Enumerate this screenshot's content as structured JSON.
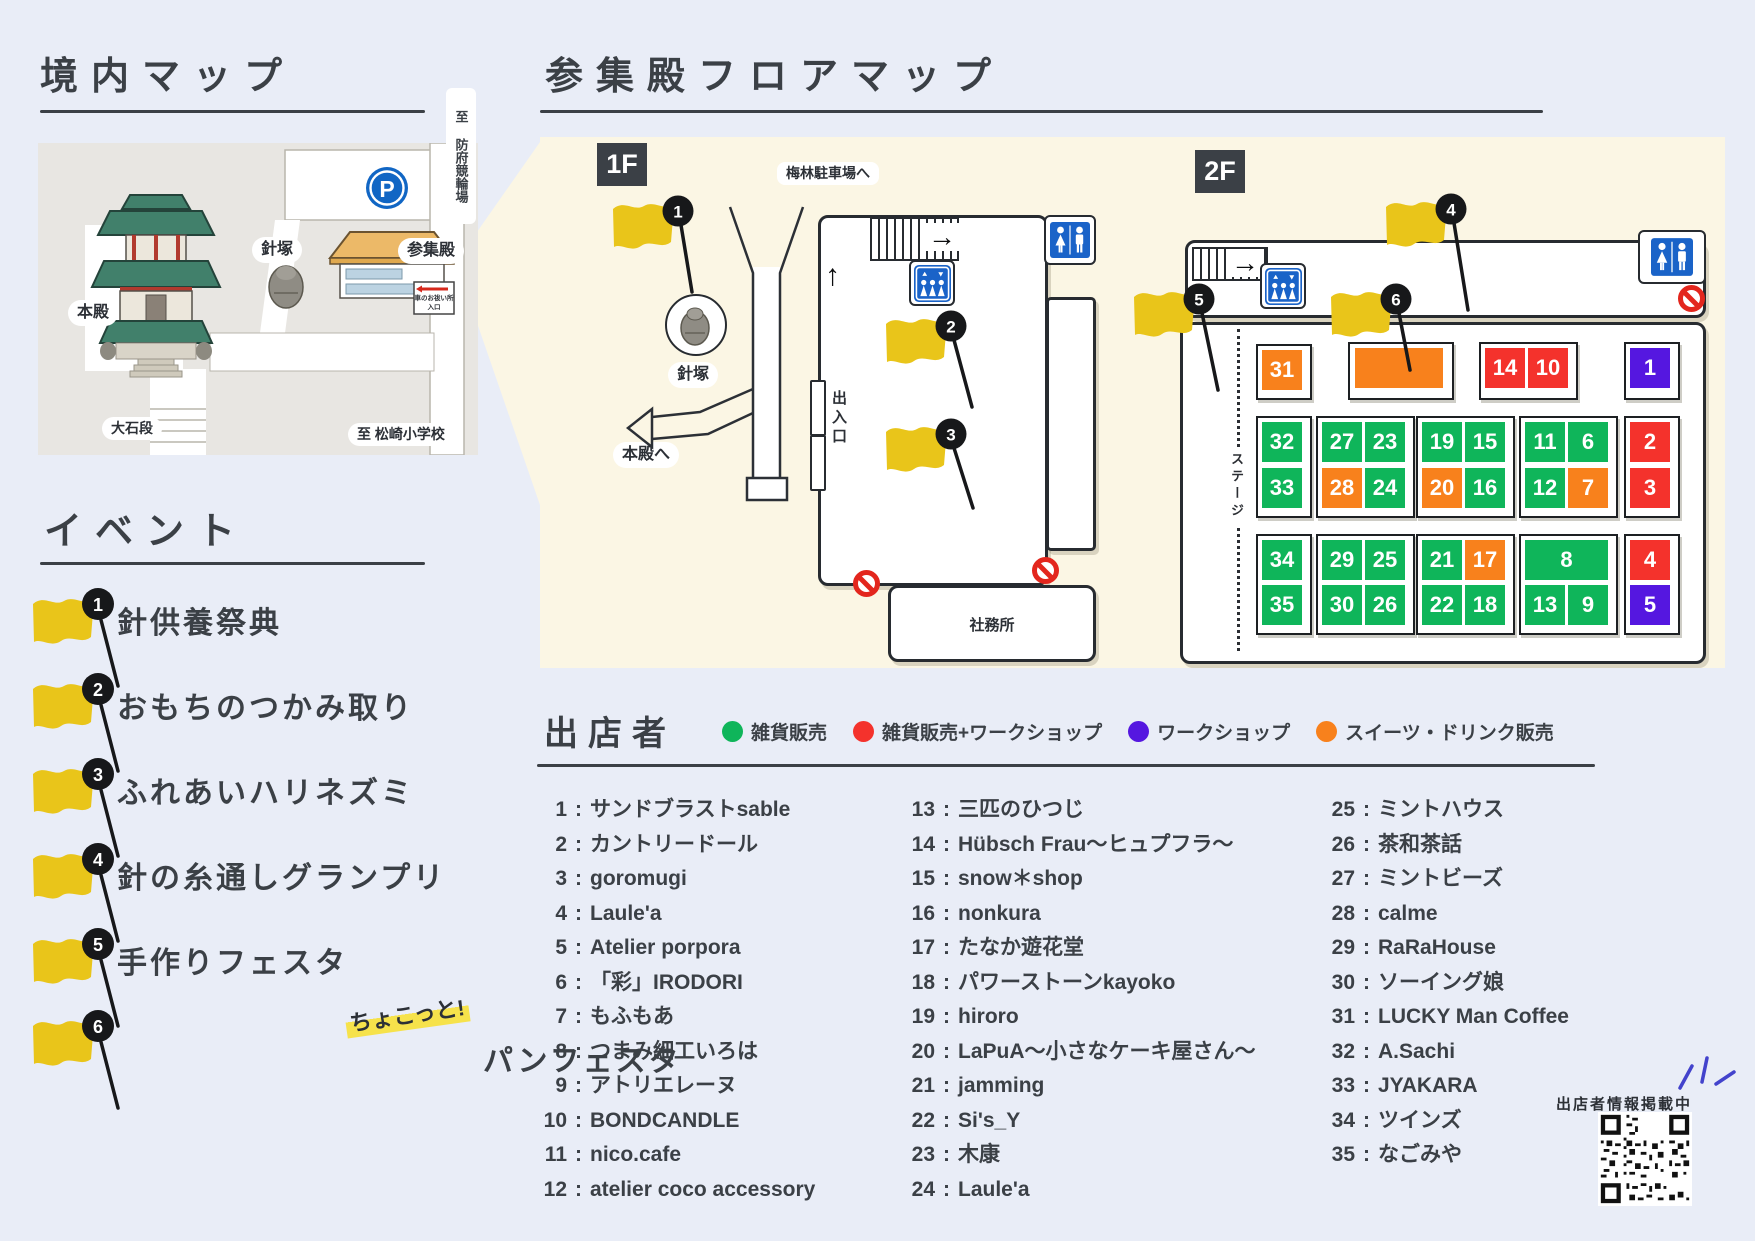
{
  "keidai": {
    "title": "境内マップ",
    "labels": {
      "honden": "本殿",
      "harizuka": "針塚",
      "sanshuden": "参集殿",
      "parking": "P",
      "oishidan": "大石段",
      "to_keirin": "至 防府競輪場",
      "to_school": "至 松崎小学校",
      "sign_line1": "車のお祓い所",
      "sign_line2": "入口"
    }
  },
  "floor_map": {
    "title": "参集殿フロアマップ",
    "f1": {
      "badge": "1F",
      "parking_label": "梅林駐車場へ",
      "harizuka": "針塚",
      "to_honden": "本殿へ",
      "entrance": "出入口",
      "office": "社務所"
    },
    "f2": {
      "badge": "2F",
      "stage": "ステージ"
    },
    "booth_colors": {
      "g": "#0fb55a",
      "r": "#f4322c",
      "p": "#5517e0",
      "o": "#f8811c"
    },
    "booths": [
      {
        "n": "31",
        "t": "o",
        "x": 722,
        "y": 213
      },
      {
        "n": "",
        "t": "o",
        "x": 815,
        "y": 211,
        "w": 88
      },
      {
        "n": "14",
        "t": "r",
        "x": 945,
        "y": 211
      },
      {
        "n": "10",
        "t": "r",
        "x": 988,
        "y": 211
      },
      {
        "n": "1",
        "t": "p",
        "x": 1090,
        "y": 211
      },
      {
        "n": "32",
        "t": "g",
        "x": 722,
        "y": 285
      },
      {
        "n": "33",
        "t": "g",
        "x": 722,
        "y": 331
      },
      {
        "n": "27",
        "t": "g",
        "x": 782,
        "y": 285
      },
      {
        "n": "23",
        "t": "g",
        "x": 825,
        "y": 285
      },
      {
        "n": "28",
        "t": "o",
        "x": 782,
        "y": 331
      },
      {
        "n": "24",
        "t": "g",
        "x": 825,
        "y": 331
      },
      {
        "n": "19",
        "t": "g",
        "x": 882,
        "y": 285
      },
      {
        "n": "15",
        "t": "g",
        "x": 925,
        "y": 285
      },
      {
        "n": "20",
        "t": "o",
        "x": 882,
        "y": 331
      },
      {
        "n": "16",
        "t": "g",
        "x": 925,
        "y": 331
      },
      {
        "n": "11",
        "t": "g",
        "x": 985,
        "y": 285
      },
      {
        "n": "6",
        "t": "g",
        "x": 1028,
        "y": 285
      },
      {
        "n": "12",
        "t": "g",
        "x": 985,
        "y": 331
      },
      {
        "n": "7",
        "t": "o",
        "x": 1028,
        "y": 331
      },
      {
        "n": "2",
        "t": "r",
        "x": 1090,
        "y": 285
      },
      {
        "n": "3",
        "t": "r",
        "x": 1090,
        "y": 331
      },
      {
        "n": "34",
        "t": "g",
        "x": 722,
        "y": 403
      },
      {
        "n": "35",
        "t": "g",
        "x": 722,
        "y": 448
      },
      {
        "n": "29",
        "t": "g",
        "x": 782,
        "y": 403
      },
      {
        "n": "25",
        "t": "g",
        "x": 825,
        "y": 403
      },
      {
        "n": "30",
        "t": "g",
        "x": 782,
        "y": 448
      },
      {
        "n": "26",
        "t": "g",
        "x": 825,
        "y": 448
      },
      {
        "n": "21",
        "t": "g",
        "x": 882,
        "y": 403
      },
      {
        "n": "17",
        "t": "o",
        "x": 925,
        "y": 403
      },
      {
        "n": "22",
        "t": "g",
        "x": 882,
        "y": 448
      },
      {
        "n": "18",
        "t": "g",
        "x": 925,
        "y": 448
      },
      {
        "n": "8",
        "t": "g",
        "x": 985,
        "y": 403,
        "w": 83
      },
      {
        "n": "13",
        "t": "g",
        "x": 985,
        "y": 448
      },
      {
        "n": "9",
        "t": "g",
        "x": 1028,
        "y": 448
      },
      {
        "n": "4",
        "t": "r",
        "x": 1090,
        "y": 403
      },
      {
        "n": "5",
        "t": "p",
        "x": 1090,
        "y": 448
      }
    ],
    "cluster_frames": [
      {
        "x": 716,
        "y": 207,
        "w": 52,
        "h": 52
      },
      {
        "x": 808,
        "y": 205,
        "w": 102,
        "h": 54
      },
      {
        "x": 939,
        "y": 205,
        "w": 95,
        "h": 54
      },
      {
        "x": 1084,
        "y": 205,
        "w": 52,
        "h": 54
      },
      {
        "x": 716,
        "y": 279,
        "w": 52,
        "h": 98
      },
      {
        "x": 776,
        "y": 279,
        "w": 95,
        "h": 98
      },
      {
        "x": 876,
        "y": 279,
        "w": 95,
        "h": 98
      },
      {
        "x": 979,
        "y": 279,
        "w": 95,
        "h": 98
      },
      {
        "x": 1084,
        "y": 279,
        "w": 52,
        "h": 98
      },
      {
        "x": 716,
        "y": 397,
        "w": 52,
        "h": 97
      },
      {
        "x": 776,
        "y": 397,
        "w": 95,
        "h": 97
      },
      {
        "x": 876,
        "y": 397,
        "w": 95,
        "h": 97
      },
      {
        "x": 979,
        "y": 397,
        "w": 95,
        "h": 97
      },
      {
        "x": 1084,
        "y": 397,
        "w": 52,
        "h": 97
      }
    ],
    "flags": [
      {
        "num": "1",
        "x": 72,
        "y": 60,
        "px": 152,
        "py": 155
      },
      {
        "num": "2",
        "x": 345,
        "y": 175,
        "px": 432,
        "py": 270
      },
      {
        "num": "3",
        "x": 345,
        "y": 283,
        "px": 433,
        "py": 371
      },
      {
        "num": "4",
        "x": 845,
        "y": 58,
        "px": 928,
        "py": 173
      },
      {
        "num": "5",
        "x": 593,
        "y": 148,
        "px": 678,
        "py": 253
      },
      {
        "num": "6",
        "x": 790,
        "y": 148,
        "px": 870,
        "py": 233
      }
    ]
  },
  "events": {
    "title": "イベント",
    "items": [
      {
        "num": "1",
        "prefix": "",
        "label": "針供養祭典"
      },
      {
        "num": "2",
        "prefix": "",
        "label": "おもちのつかみ取り"
      },
      {
        "num": "3",
        "prefix": "",
        "label": "ふれあいハリネズミ"
      },
      {
        "num": "4",
        "prefix": "",
        "label": "針の糸通しグランプリ"
      },
      {
        "num": "5",
        "prefix": "",
        "label": "手作りフェスタ"
      },
      {
        "num": "6",
        "prefix": "ちょこっと!",
        "label": "パンフェスタ"
      }
    ]
  },
  "vendors": {
    "title": "出店者",
    "legend": [
      {
        "color": "#0fb55a",
        "label": "雑貨販売"
      },
      {
        "color": "#f4322c",
        "label": "雑貨販売+ワークショップ"
      },
      {
        "color": "#5517e0",
        "label": "ワークショップ"
      },
      {
        "color": "#f8811c",
        "label": "スイーツ・ドリンク販売"
      }
    ],
    "columns": [
      [
        {
          "n": "1",
          "label": "サンドブラストsable"
        },
        {
          "n": "2",
          "label": "カントリードール"
        },
        {
          "n": "3",
          "label": "goromugi"
        },
        {
          "n": "4",
          "label": "Laule'a"
        },
        {
          "n": "5",
          "label": "Atelier porpora"
        },
        {
          "n": "6",
          "label": "「彩」IRODORI"
        },
        {
          "n": "7",
          "label": "もふもあ"
        },
        {
          "n": "8",
          "label": "つまみ細工いろは"
        },
        {
          "n": "9",
          "label": "アトリエレーヌ"
        },
        {
          "n": "10",
          "label": "BONDCANDLE"
        },
        {
          "n": "11",
          "label": "nico.cafe"
        },
        {
          "n": "12",
          "label": "atelier coco accessory"
        }
      ],
      [
        {
          "n": "13",
          "label": "三匹のひつじ"
        },
        {
          "n": "14",
          "label": "Hübsch Frau～ヒュプフラ～"
        },
        {
          "n": "15",
          "label": "snow＊shop"
        },
        {
          "n": "16",
          "label": "nonkura"
        },
        {
          "n": "17",
          "label": "たなか遊花堂"
        },
        {
          "n": "18",
          "label": "パワーストーンkayoko"
        },
        {
          "n": "19",
          "label": "hiroro"
        },
        {
          "n": "20",
          "label": "LaPuA～小さなケーキ屋さん～"
        },
        {
          "n": "21",
          "label": "jamming"
        },
        {
          "n": "22",
          "label": "Si's_Y"
        },
        {
          "n": "23",
          "label": "木康"
        },
        {
          "n": "24",
          "label": "Laule'a"
        }
      ],
      [
        {
          "n": "25",
          "label": "ミントハウス"
        },
        {
          "n": "26",
          "label": "茶和茶話"
        },
        {
          "n": "27",
          "label": "ミントビーズ"
        },
        {
          "n": "28",
          "label": "calme"
        },
        {
          "n": "29",
          "label": "RaRaHouse"
        },
        {
          "n": "30",
          "label": "ソーイング娘"
        },
        {
          "n": "31",
          "label": "LUCKY Man Coffee"
        },
        {
          "n": "32",
          "label": "A.Sachi"
        },
        {
          "n": "33",
          "label": "JYAKARA"
        },
        {
          "n": "34",
          "label": "ツインズ"
        },
        {
          "n": "35",
          "label": "なごみや"
        }
      ]
    ],
    "qr_note": "出店者情報掲載中"
  }
}
